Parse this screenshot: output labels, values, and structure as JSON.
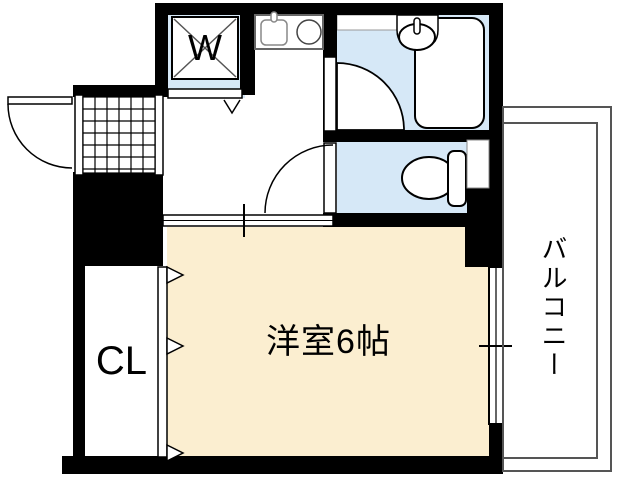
{
  "plan": {
    "title": "apartment-floor-plan",
    "rooms": {
      "main_room": {
        "label": "洋室6帖"
      },
      "closet": {
        "label": "CL"
      },
      "balcony": {
        "label": "バルコニー"
      },
      "washer": {
        "label": "W"
      }
    },
    "colors": {
      "room_cream": "#FBEED0",
      "wet_area_blue": "#D6E8F7",
      "wall_black": "#000000",
      "balcony_line_gray": "#555555"
    }
  }
}
